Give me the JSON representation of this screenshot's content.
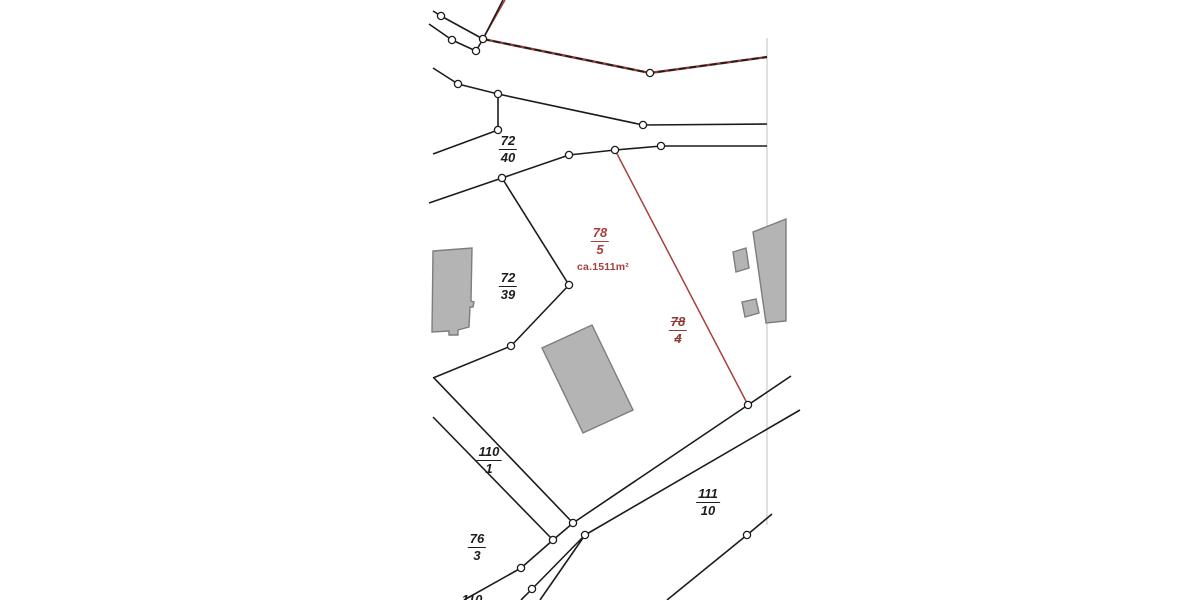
{
  "map": {
    "colors": {
      "background": "#ffffff",
      "line": "#1c1c1c",
      "red": "#a8403c",
      "red_dark": "#8f3c36",
      "building_fill": "#b4b4b4",
      "building_stroke": "#7d7d7d",
      "sheet_edge": "#cccccc",
      "vertex_fill": "#ffffff"
    },
    "parcels": [
      {
        "name": "72-40",
        "numerator": "72",
        "denominator": "40",
        "x": 508,
        "y": 134,
        "style": "black"
      },
      {
        "name": "72-39",
        "numerator": "72",
        "denominator": "39",
        "x": 508,
        "y": 271,
        "style": "black"
      },
      {
        "name": "78-5",
        "numerator": "78",
        "denominator": "5",
        "x": 600,
        "y": 226,
        "style": "red"
      },
      {
        "name": "78-4",
        "numerator": "78",
        "denominator": "4",
        "x": 678,
        "y": 315,
        "style": "red-struck"
      },
      {
        "name": "110-1",
        "numerator": "110",
        "denominator": "1",
        "x": 489,
        "y": 445,
        "style": "black"
      },
      {
        "name": "111-10",
        "numerator": "111",
        "denominator": "10",
        "x": 708,
        "y": 487,
        "style": "black"
      },
      {
        "name": "76-3",
        "numerator": "76",
        "denominator": "3",
        "x": 477,
        "y": 532,
        "style": "black"
      },
      {
        "name": "110-partial",
        "numerator": "110",
        "denominator": "",
        "x": 472,
        "y": 593,
        "style": "black"
      }
    ],
    "area_label": {
      "text": "ca.1511m²",
      "x": 603,
      "y": 261
    },
    "geometry": {
      "black_lines": [
        [
          [
            433,
            11
          ],
          [
            441,
            16
          ],
          [
            483,
            39
          ]
        ],
        [
          [
            429,
            24
          ],
          [
            452,
            40
          ],
          [
            476,
            51
          ],
          [
            483,
            39
          ]
        ],
        [
          [
            503,
            0
          ],
          [
            483,
            39
          ]
        ],
        [
          [
            433,
            68
          ],
          [
            458,
            84
          ],
          [
            498,
            94
          ]
        ],
        [
          [
            498,
            94
          ],
          [
            643,
            125
          ],
          [
            767,
            124
          ]
        ],
        [
          [
            498,
            94
          ],
          [
            498,
            130
          ]
        ],
        [
          [
            498,
            130
          ],
          [
            433,
            154
          ]
        ],
        [
          [
            429,
            203
          ],
          [
            502,
            178
          ]
        ],
        [
          [
            502,
            178
          ],
          [
            569,
            155
          ],
          [
            615,
            150
          ],
          [
            661,
            146
          ],
          [
            767,
            146
          ]
        ],
        [
          [
            502,
            178
          ],
          [
            569,
            285
          ],
          [
            511,
            346
          ],
          [
            433,
            378
          ]
        ],
        [
          [
            434,
            378
          ],
          [
            573,
            523
          ]
        ],
        [
          [
            433,
            417
          ],
          [
            553,
            540
          ]
        ],
        [
          [
            573,
            523
          ],
          [
            553,
            540
          ],
          [
            521,
            568
          ],
          [
            464,
            600
          ]
        ],
        [
          [
            573,
            523
          ],
          [
            748,
            405
          ],
          [
            791,
            376
          ]
        ],
        [
          [
            585,
            535
          ],
          [
            800,
            410
          ]
        ],
        [
          [
            585,
            535
          ],
          [
            532,
            589
          ],
          [
            521,
            600
          ]
        ],
        [
          [
            585,
            535
          ],
          [
            540,
            600
          ]
        ],
        [
          [
            667,
            600
          ],
          [
            747,
            535
          ],
          [
            772,
            514
          ]
        ]
      ],
      "red_lines": [
        [
          [
            615,
            150
          ],
          [
            748,
            405
          ]
        ],
        [
          [
            505,
            0
          ],
          [
            484,
            37
          ]
        ]
      ],
      "dashed_boundary": [
        [
          483,
          39
        ],
        [
          650,
          73
        ],
        [
          767,
          57
        ]
      ],
      "sheet_edge": [
        [
          767,
          38
        ],
        [
          767,
          525
        ]
      ],
      "vertices": [
        [
          441,
          16
        ],
        [
          452,
          40
        ],
        [
          476,
          51
        ],
        [
          483,
          39
        ],
        [
          458,
          84
        ],
        [
          498,
          94
        ],
        [
          498,
          130
        ],
        [
          643,
          125
        ],
        [
          650,
          73
        ],
        [
          502,
          178
        ],
        [
          569,
          155
        ],
        [
          615,
          150
        ],
        [
          661,
          146
        ],
        [
          569,
          285
        ],
        [
          511,
          346
        ],
        [
          748,
          405
        ],
        [
          573,
          523
        ],
        [
          553,
          540
        ],
        [
          585,
          535
        ],
        [
          521,
          568
        ],
        [
          532,
          589
        ],
        [
          747,
          535
        ]
      ],
      "buildings": [
        [
          [
            433,
            251
          ],
          [
            472,
            248
          ],
          [
            471,
            301
          ],
          [
            474,
            302
          ],
          [
            473,
            307
          ],
          [
            470,
            307
          ],
          [
            469,
            327
          ],
          [
            458,
            330
          ],
          [
            458,
            335
          ],
          [
            449,
            335
          ],
          [
            449,
            331
          ],
          [
            432,
            332
          ]
        ],
        [
          [
            592,
            325
          ],
          [
            633,
            410
          ],
          [
            583,
            433
          ],
          [
            542,
            348
          ]
        ],
        [
          [
            753,
            232
          ],
          [
            786,
            219
          ],
          [
            786,
            321
          ],
          [
            766,
            323
          ]
        ],
        [
          [
            733,
            252
          ],
          [
            746,
            248
          ],
          [
            749,
            268
          ],
          [
            736,
            272
          ]
        ],
        [
          [
            742,
            302
          ],
          [
            756,
            299
          ],
          [
            759,
            313
          ],
          [
            745,
            317
          ]
        ]
      ]
    }
  }
}
